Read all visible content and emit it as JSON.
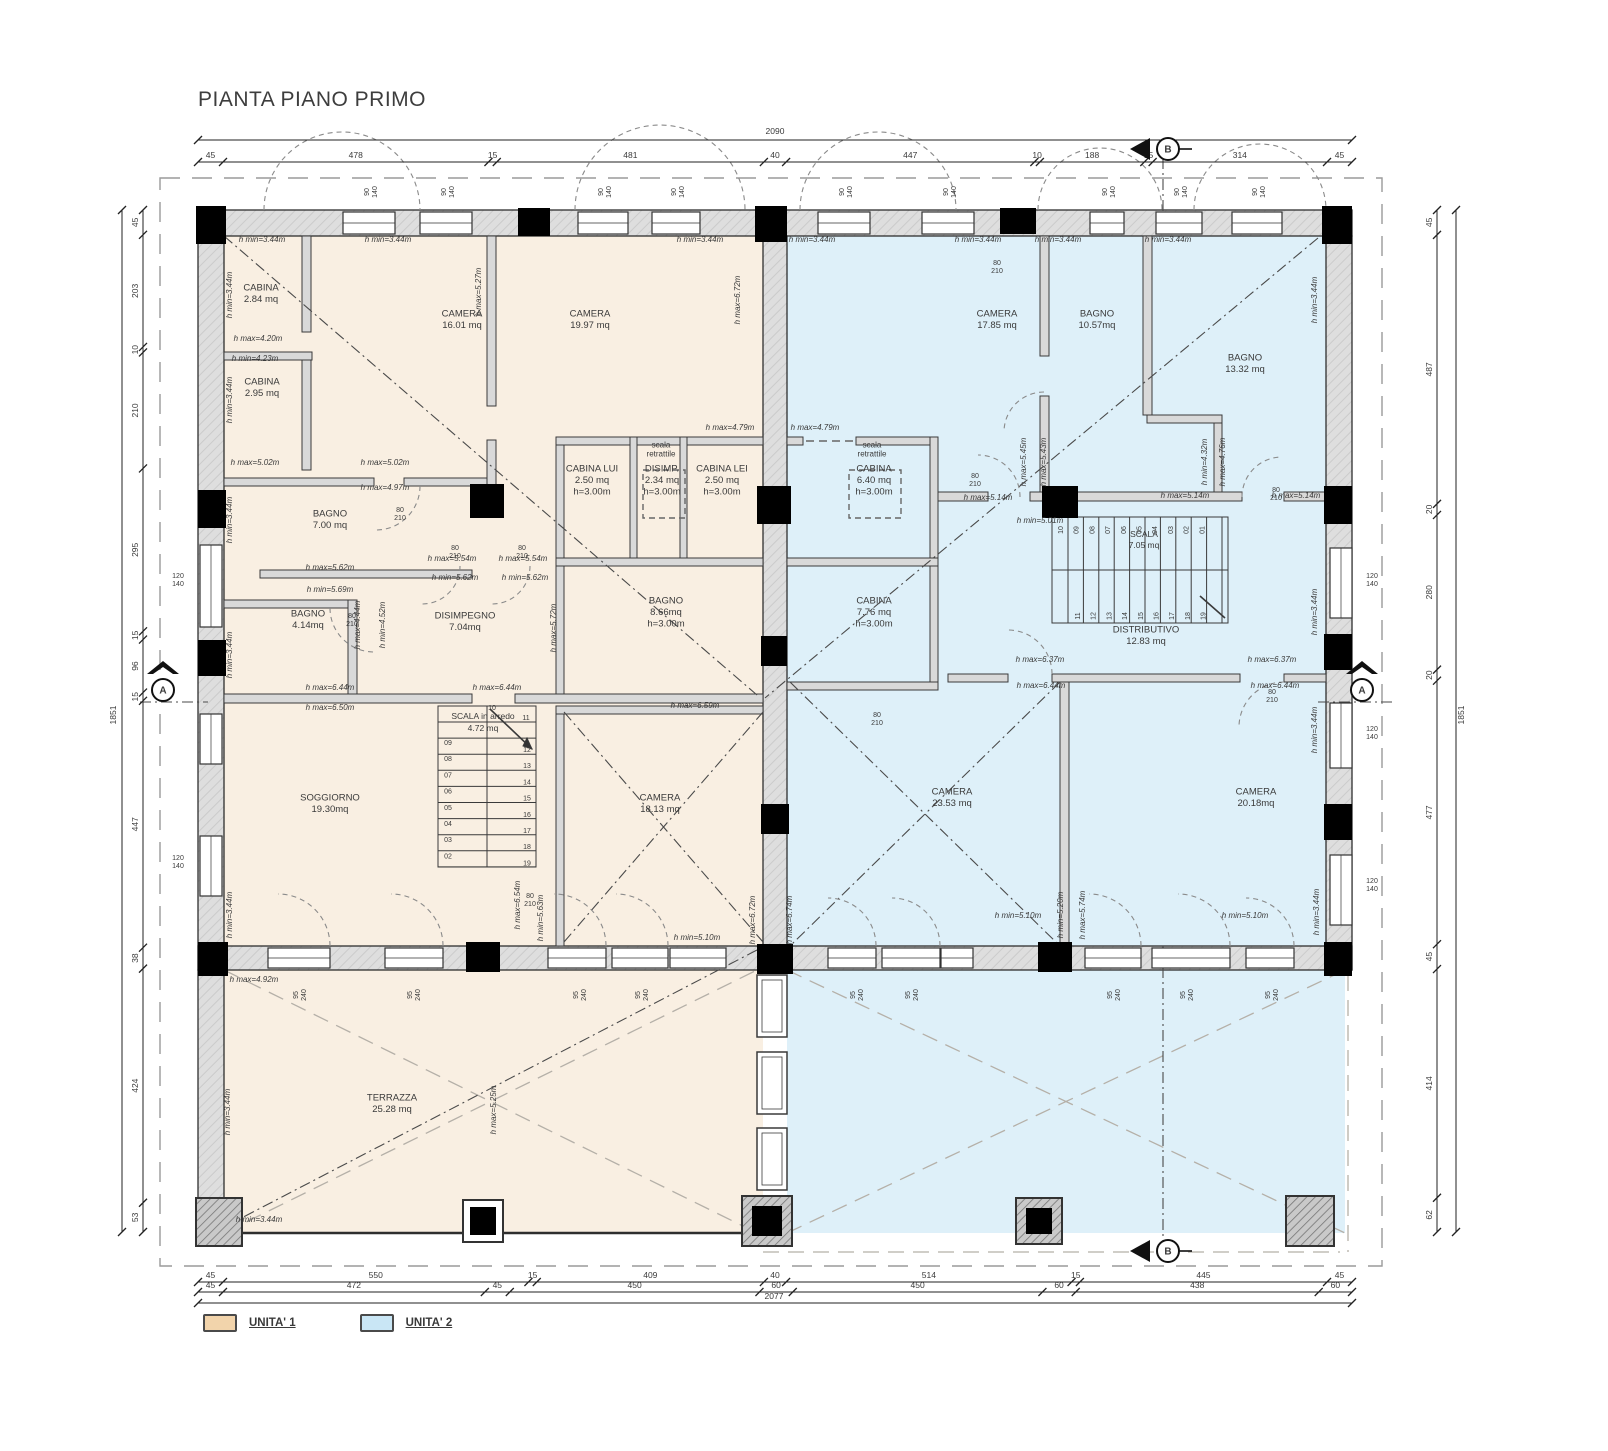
{
  "title": "PIANTA PIANO PRIMO",
  "legend": [
    {
      "label": "UNITA' 1",
      "color": "#f2d4ab"
    },
    {
      "label": "UNITA' 2",
      "color": "#c9e6f5"
    }
  ],
  "unit_fills": {
    "unit1": "#f9efe2",
    "unit2": "#def0f9"
  },
  "rooms": [
    {
      "lines": [
        "CABINA",
        "2.84 mq"
      ],
      "x": 261,
      "y": 296
    },
    {
      "lines": [
        "CABINA",
        "2.95 mq"
      ],
      "x": 262,
      "y": 390
    },
    {
      "lines": [
        "CAMERA",
        "16.01 mq"
      ],
      "x": 462,
      "y": 322
    },
    {
      "lines": [
        "CAMERA",
        "19.97 mq"
      ],
      "x": 590,
      "y": 322
    },
    {
      "lines": [
        "scala",
        "retrattile"
      ],
      "x": 661,
      "y": 452,
      "sm": 1
    },
    {
      "lines": [
        "CABINA LUI",
        "2.50 mq",
        "h=3.00m"
      ],
      "x": 592,
      "y": 483
    },
    {
      "lines": [
        "DISIMP.",
        "2.34 mq",
        "h=3.00m"
      ],
      "x": 662,
      "y": 483
    },
    {
      "lines": [
        "CABINA LEI",
        "2.50 mq",
        "h=3.00m"
      ],
      "x": 722,
      "y": 483
    },
    {
      "lines": [
        "BAGNO",
        "7.00 mq"
      ],
      "x": 330,
      "y": 522
    },
    {
      "lines": [
        "BAGNO",
        "4.14mq"
      ],
      "x": 308,
      "y": 622
    },
    {
      "lines": [
        "DISIMPEGNO",
        "7.04mq"
      ],
      "x": 465,
      "y": 624
    },
    {
      "lines": [
        "BAGNO",
        "8.66mq",
        "h=3.00m"
      ],
      "x": 666,
      "y": 615
    },
    {
      "lines": [
        "SOGGIORNO",
        "19.30mq"
      ],
      "x": 330,
      "y": 806
    },
    {
      "lines": [
        "CAMERA",
        "18.13 mq"
      ],
      "x": 660,
      "y": 806
    },
    {
      "lines": [
        "TERRAZZA",
        "25.28 mq"
      ],
      "x": 392,
      "y": 1106
    },
    {
      "lines": [
        "CAMERA",
        "17.85 mq"
      ],
      "x": 997,
      "y": 322
    },
    {
      "lines": [
        "BAGNO",
        "10.57mq"
      ],
      "x": 1097,
      "y": 322
    },
    {
      "lines": [
        "BAGNO",
        "13.32 mq"
      ],
      "x": 1245,
      "y": 366
    },
    {
      "lines": [
        "scala",
        "retrattile"
      ],
      "x": 872,
      "y": 452,
      "sm": 1
    },
    {
      "lines": [
        "CABINA",
        "6.40 mq",
        "h=3.00m"
      ],
      "x": 874,
      "y": 483
    },
    {
      "lines": [
        "CABINA",
        "7.76 mq",
        "h=3.00m"
      ],
      "x": 874,
      "y": 615
    },
    {
      "lines": [
        "DISTRIBUTIVO",
        "12.83 mq"
      ],
      "x": 1146,
      "y": 638
    },
    {
      "lines": [
        "CAMERA",
        "23.53 mq"
      ],
      "x": 952,
      "y": 800
    },
    {
      "lines": [
        "CAMERA",
        "20.18mq"
      ],
      "x": 1256,
      "y": 800
    }
  ],
  "stairs": {
    "unit1": {
      "label": [
        "SCALA in arredo",
        "4.72 mq"
      ],
      "top": [
        "10",
        "11"
      ],
      "left_col": [
        "09",
        "08",
        "07",
        "06",
        "05",
        "04",
        "03",
        "02"
      ],
      "right_col": [
        "12",
        "13",
        "14",
        "15",
        "16",
        "17",
        "18",
        "19"
      ]
    },
    "unit2": {
      "label": [
        "SCALA",
        "7.05 mq"
      ],
      "top_row": [
        "10",
        "09",
        "08",
        "07",
        "06",
        "05",
        "04",
        "03",
        "02",
        "01"
      ],
      "bottom_row": [
        "11",
        "12",
        "13",
        "14",
        "15",
        "16",
        "17",
        "18",
        "19"
      ]
    }
  },
  "heights": [
    {
      "t": "h min=3.44m",
      "x": 262,
      "y": 242
    },
    {
      "t": "h min=3.44m",
      "x": 388,
      "y": 242
    },
    {
      "t": "h min=3.44m",
      "x": 700,
      "y": 242
    },
    {
      "t": "h min=3.44m",
      "x": 812,
      "y": 242
    },
    {
      "t": "h min=3.44m",
      "x": 978,
      "y": 242
    },
    {
      "t": "h min=3.44m",
      "x": 1058,
      "y": 242
    },
    {
      "t": "h min=3.44m",
      "x": 1168,
      "y": 242
    },
    {
      "t": "h min=3.44m",
      "x": 232,
      "y": 295,
      "r": 1
    },
    {
      "t": "h min=3.44m",
      "x": 232,
      "y": 400,
      "r": 1
    },
    {
      "t": "h min=3.44m",
      "x": 232,
      "y": 520,
      "r": 1
    },
    {
      "t": "h min=3.44m",
      "x": 232,
      "y": 655,
      "r": 1
    },
    {
      "t": "h min=3.44m",
      "x": 232,
      "y": 915,
      "r": 1
    },
    {
      "t": "h min=3.44m",
      "x": 230,
      "y": 1112,
      "r": 1
    },
    {
      "t": "h min=3.44m",
      "x": 259,
      "y": 1222
    },
    {
      "t": "h max=5.27m",
      "x": 481,
      "y": 292,
      "r": 1
    },
    {
      "t": "h max=6.72m",
      "x": 740,
      "y": 300,
      "r": 1
    },
    {
      "t": "h max=4.20m",
      "x": 258,
      "y": 341
    },
    {
      "t": "h min=4.23m",
      "x": 255,
      "y": 361
    },
    {
      "t": "h max=5.02m",
      "x": 255,
      "y": 465
    },
    {
      "t": "h max=5.02m",
      "x": 385,
      "y": 465
    },
    {
      "t": "h max=4.97m",
      "x": 385,
      "y": 490
    },
    {
      "t": "h max=5.62m",
      "x": 330,
      "y": 570
    },
    {
      "t": "h min=5.69m",
      "x": 330,
      "y": 592
    },
    {
      "t": "h max=5.54m",
      "x": 452,
      "y": 561
    },
    {
      "t": "h max=5.54m",
      "x": 523,
      "y": 561
    },
    {
      "t": "h min=5.62m",
      "x": 455,
      "y": 580
    },
    {
      "t": "h min=5.62m",
      "x": 525,
      "y": 580
    },
    {
      "t": "h max=4.44m",
      "x": 360,
      "y": 625,
      "r": 1
    },
    {
      "t": "h min=4.52m",
      "x": 385,
      "y": 625,
      "r": 1
    },
    {
      "t": "h max=5.72m",
      "x": 556,
      "y": 628,
      "r": 1
    },
    {
      "t": "h max=6.44m",
      "x": 330,
      "y": 690
    },
    {
      "t": "h max=6.44m",
      "x": 497,
      "y": 690
    },
    {
      "t": "h max=6.50m",
      "x": 330,
      "y": 710
    },
    {
      "t": "h max=6.59m",
      "x": 695,
      "y": 708
    },
    {
      "t": "h min=5.10m",
      "x": 697,
      "y": 940
    },
    {
      "t": "h max=6.72m",
      "x": 755,
      "y": 920,
      "r": 1
    },
    {
      "t": "h max=6.74m",
      "x": 792,
      "y": 920,
      "r": 1
    },
    {
      "t": "h min=5.63m",
      "x": 543,
      "y": 918,
      "r": 1
    },
    {
      "t": "h max=6.54m",
      "x": 520,
      "y": 905,
      "r": 1
    },
    {
      "t": "h max=4.79m",
      "x": 730,
      "y": 430
    },
    {
      "t": "h max=4.79m",
      "x": 815,
      "y": 430
    },
    {
      "t": "h max=4.92m",
      "x": 254,
      "y": 982
    },
    {
      "t": "h max=5.25m",
      "x": 496,
      "y": 1110,
      "r": 1
    },
    {
      "t": "h max=5.45m",
      "x": 1026,
      "y": 462,
      "r": 1
    },
    {
      "t": "h max=5.43m",
      "x": 1046,
      "y": 462,
      "r": 1
    },
    {
      "t": "h max=5.14m",
      "x": 988,
      "y": 500
    },
    {
      "t": "h min=5.01m",
      "x": 1040,
      "y": 523
    },
    {
      "t": "h max=5.14m",
      "x": 1185,
      "y": 498
    },
    {
      "t": "h max=5.14m",
      "x": 1296,
      "y": 498
    },
    {
      "t": "h min=4.32m",
      "x": 1207,
      "y": 462,
      "r": 1
    },
    {
      "t": "h max=4.76m",
      "x": 1225,
      "y": 462,
      "r": 1
    },
    {
      "t": "h min=3.44m",
      "x": 1317,
      "y": 300,
      "r": 1
    },
    {
      "t": "h min=3.44m",
      "x": 1317,
      "y": 612,
      "r": 1
    },
    {
      "t": "h min=3.44m",
      "x": 1317,
      "y": 730,
      "r": 1
    },
    {
      "t": "h min=3.44m",
      "x": 1319,
      "y": 912,
      "r": 1
    },
    {
      "t": "h max=6.37m",
      "x": 1040,
      "y": 662
    },
    {
      "t": "h max=6.44m",
      "x": 1041,
      "y": 688
    },
    {
      "t": "h max=6.37m",
      "x": 1272,
      "y": 662
    },
    {
      "t": "h max=6.44m",
      "x": 1275,
      "y": 688
    },
    {
      "t": "h min=5.20m",
      "x": 1063,
      "y": 915,
      "r": 1
    },
    {
      "t": "h max=5.74m",
      "x": 1085,
      "y": 915,
      "r": 1
    },
    {
      "t": "h min=5.10m",
      "x": 1018,
      "y": 918
    },
    {
      "t": "h min=5.10m",
      "x": 1245,
      "y": 918
    }
  ],
  "window_labels": [
    {
      "t": "90/140",
      "x": 369,
      "y": 192,
      "r": 1
    },
    {
      "t": "90/140",
      "x": 446,
      "y": 192,
      "r": 1
    },
    {
      "t": "90/140",
      "x": 603,
      "y": 192,
      "r": 1
    },
    {
      "t": "90/140",
      "x": 676,
      "y": 192,
      "r": 1
    },
    {
      "t": "90/140",
      "x": 844,
      "y": 192,
      "r": 1
    },
    {
      "t": "90/140",
      "x": 948,
      "y": 192,
      "r": 1
    },
    {
      "t": "90/140",
      "x": 1107,
      "y": 192,
      "r": 1
    },
    {
      "t": "90/140",
      "x": 1179,
      "y": 192,
      "r": 1
    },
    {
      "t": "90/140",
      "x": 1257,
      "y": 192,
      "r": 1
    },
    {
      "t": "120/140",
      "x": 178,
      "y": 578
    },
    {
      "t": "120/140",
      "x": 178,
      "y": 860
    },
    {
      "t": "120/140",
      "x": 1372,
      "y": 578
    },
    {
      "t": "120/140",
      "x": 1372,
      "y": 731
    },
    {
      "t": "120/140",
      "x": 1372,
      "y": 883
    },
    {
      "t": "95/240",
      "x": 298,
      "y": 995,
      "r": 1
    },
    {
      "t": "95/240",
      "x": 412,
      "y": 995,
      "r": 1
    },
    {
      "t": "95/240",
      "x": 578,
      "y": 995,
      "r": 1
    },
    {
      "t": "95/240",
      "x": 640,
      "y": 995,
      "r": 1
    },
    {
      "t": "95/240",
      "x": 855,
      "y": 995,
      "r": 1
    },
    {
      "t": "95/240",
      "x": 910,
      "y": 995,
      "r": 1
    },
    {
      "t": "95/240",
      "x": 1112,
      "y": 995,
      "r": 1
    },
    {
      "t": "95/240",
      "x": 1185,
      "y": 995,
      "r": 1
    },
    {
      "t": "95/240",
      "x": 1270,
      "y": 995,
      "r": 1
    }
  ],
  "door_labels": [
    {
      "t": "80/210",
      "x": 400,
      "y": 512
    },
    {
      "t": "80/210",
      "x": 455,
      "y": 550
    },
    {
      "t": "80/210",
      "x": 522,
      "y": 550
    },
    {
      "t": "80/210",
      "x": 352,
      "y": 618
    },
    {
      "t": "80/210",
      "x": 530,
      "y": 898
    },
    {
      "t": "80/210",
      "x": 997,
      "y": 265
    },
    {
      "t": "80/210",
      "x": 975,
      "y": 478
    },
    {
      "t": "80/210",
      "x": 1276,
      "y": 492
    },
    {
      "t": "80/210",
      "x": 1272,
      "y": 694
    },
    {
      "t": "80/210",
      "x": 877,
      "y": 717
    }
  ],
  "dims": {
    "top": {
      "total": "2090",
      "segments": [
        "45",
        "478",
        "15",
        "481",
        "40",
        "447",
        "10",
        "188",
        "15",
        "314",
        "45"
      ]
    },
    "bottom": {
      "total": "2077",
      "rows": [
        [
          "45",
          "550",
          "15",
          "409",
          "40",
          "514",
          "15",
          "445",
          "45"
        ],
        [
          "45",
          "472",
          "45",
          "450",
          "60",
          "450",
          "60",
          "438",
          "60"
        ]
      ]
    },
    "left": {
      "total": "1851",
      "segments": [
        "45",
        "203",
        "10",
        "210",
        "295",
        "15",
        "96",
        "15",
        "447",
        "38",
        "424",
        "53"
      ]
    },
    "right": {
      "total": "1851",
      "segments": [
        "45",
        "487",
        "20",
        "280",
        "20",
        "477",
        "45",
        "414",
        "62"
      ]
    }
  },
  "markers": {
    "section_a": "A",
    "section_b": "B"
  }
}
